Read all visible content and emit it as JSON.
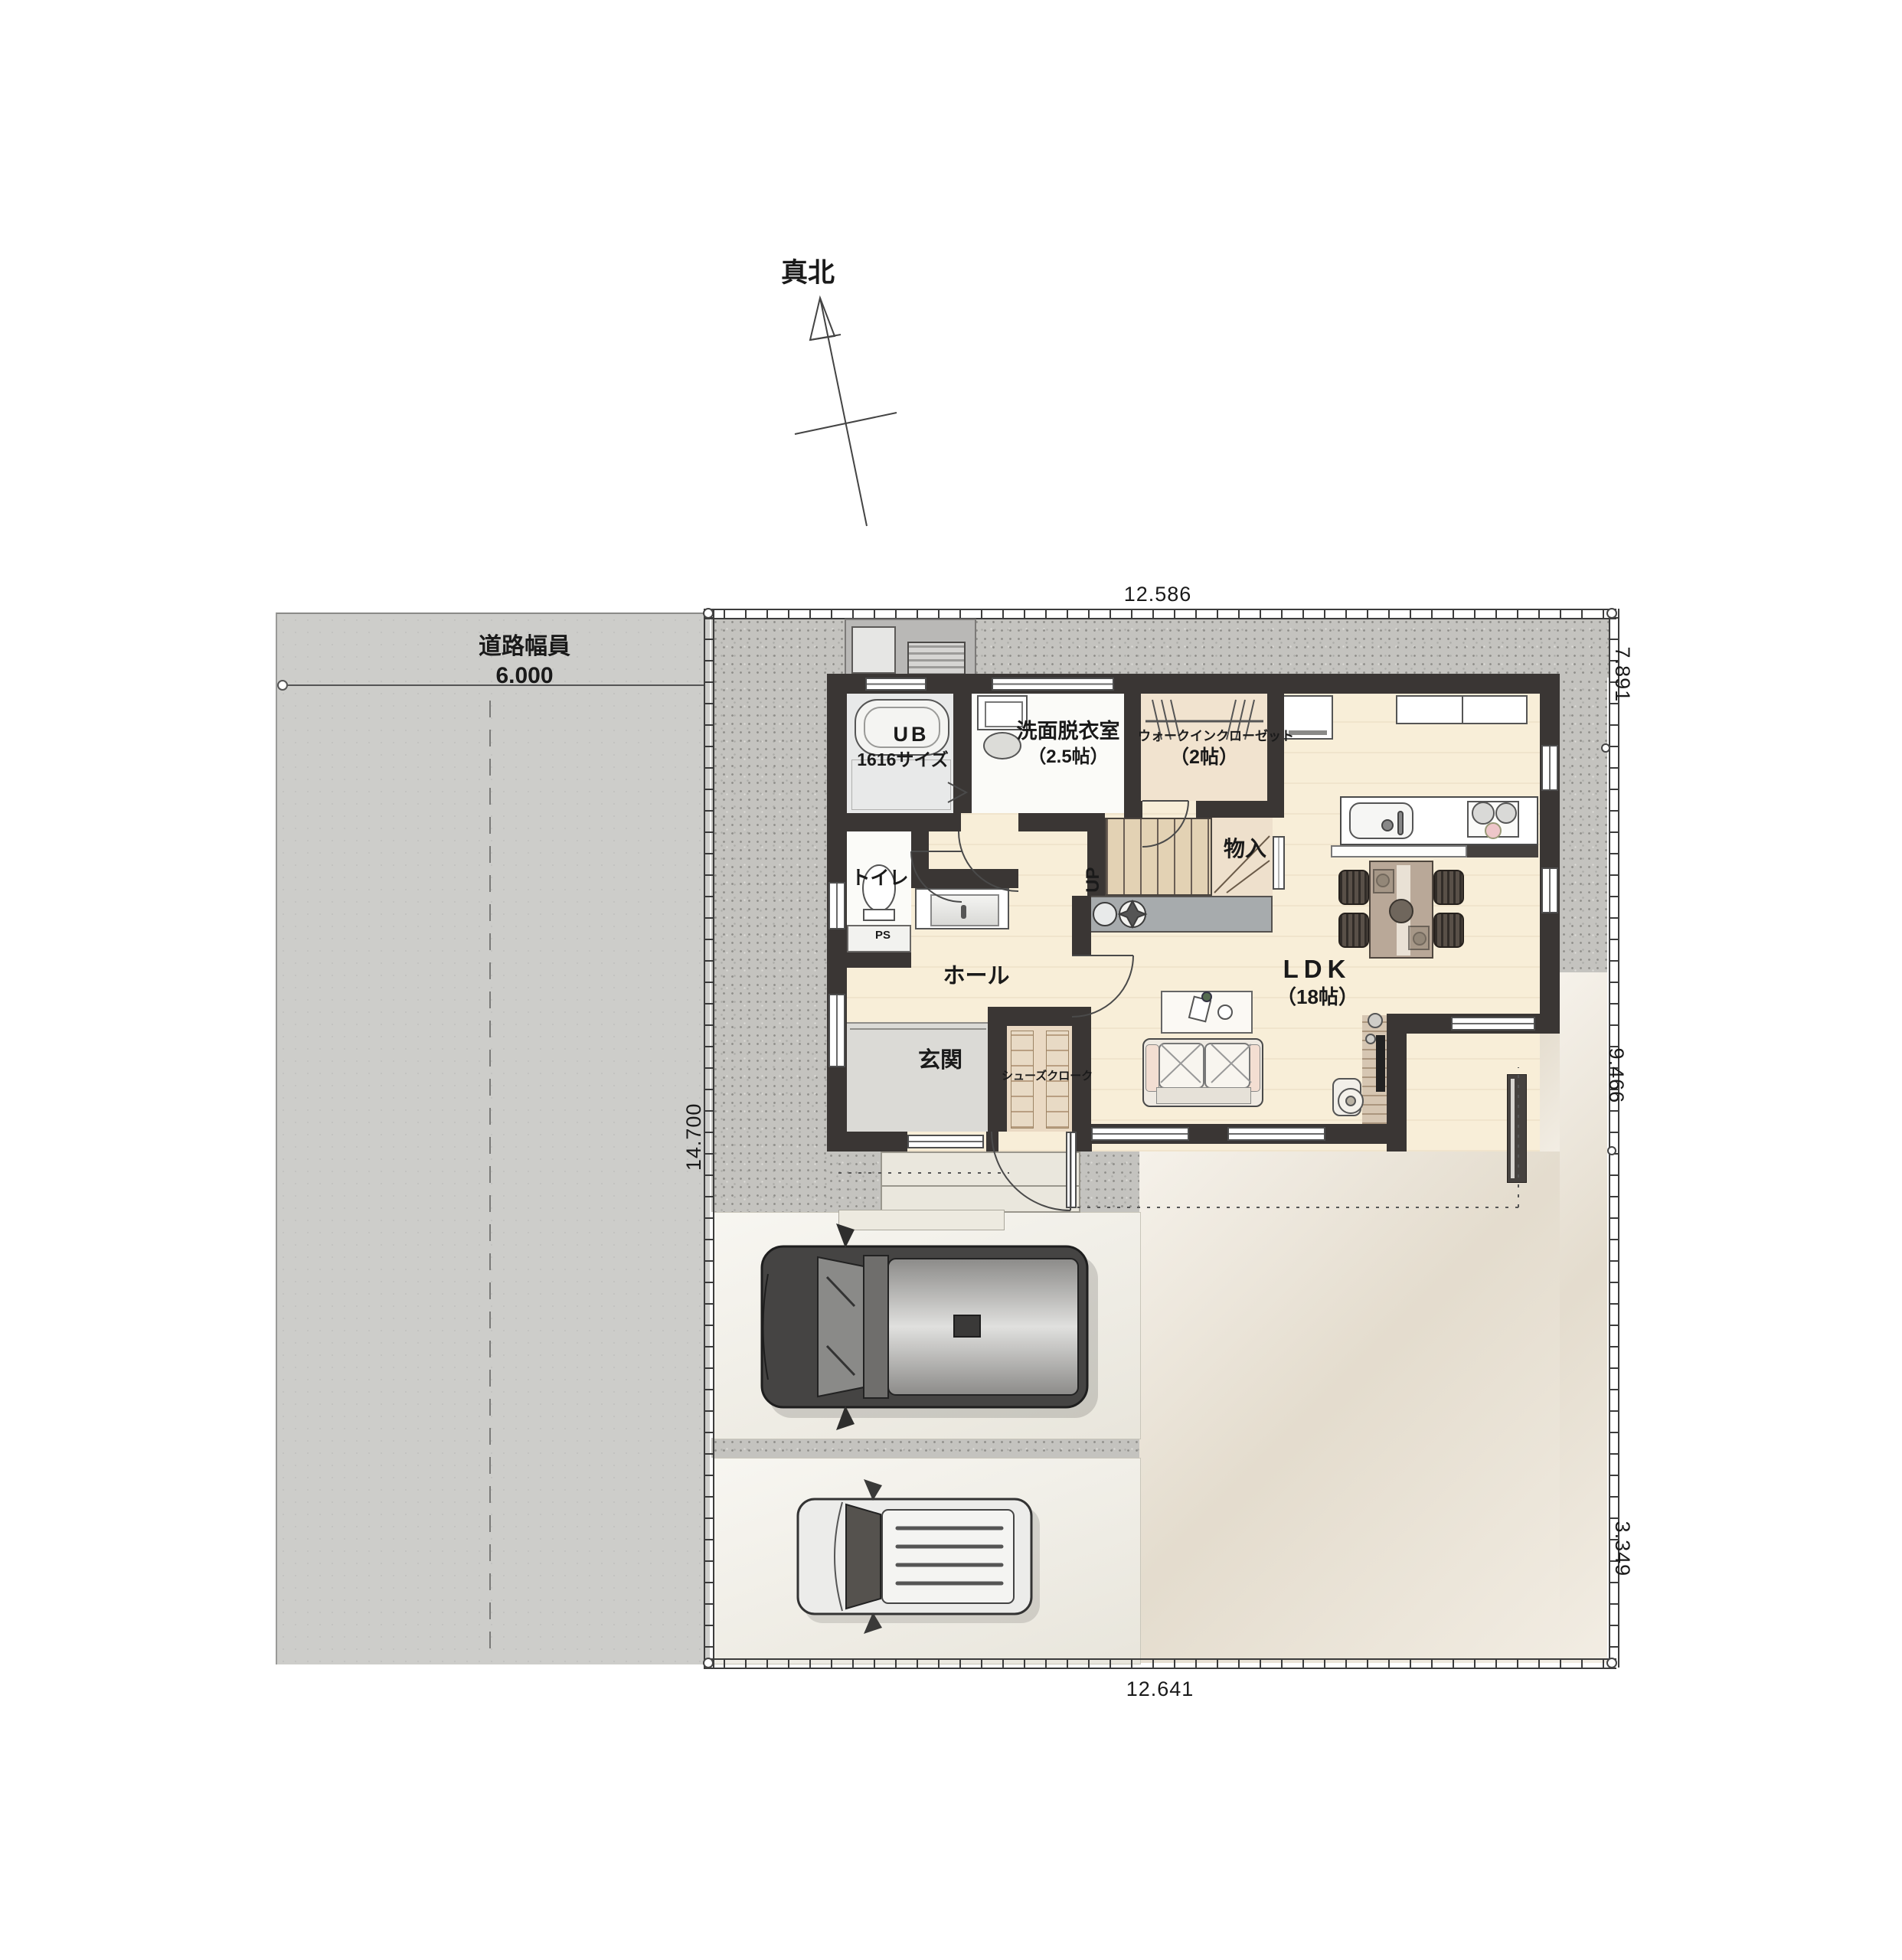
{
  "compass": {
    "label": "真北"
  },
  "road": {
    "name": "道路幅員",
    "width": "6.000"
  },
  "dimensions": {
    "top": "12.586",
    "bottom": "12.641",
    "left": "14.700",
    "right_top": "7.891",
    "right_middle": "9.466",
    "right_bottom": "3.349"
  },
  "rooms": {
    "ub": {
      "name": "UB",
      "size": "1616サイズ"
    },
    "senmen": {
      "name": "洗面脱衣室",
      "size": "（2.5帖）"
    },
    "wic": {
      "name": "ウォークインクローゼット",
      "size": "（2帖）"
    },
    "toilet": {
      "name": "トイレ"
    },
    "ps": {
      "name": "PS"
    },
    "hall": {
      "name": "ホール"
    },
    "genkan": {
      "name": "玄関"
    },
    "shoecloak": {
      "name": "シューズクローク"
    },
    "monoire": {
      "name": "物入"
    },
    "stairs": {
      "name": "UP"
    },
    "ldk": {
      "name": "LDK",
      "size": "（18帖）"
    }
  },
  "colors": {
    "wall": "#3a3634",
    "wood_floor": "#f8eed8",
    "gravel": "#c4c3bf",
    "road": "#cdcdca",
    "terrace": "#ece4d5",
    "parking": "#f0ede3",
    "entrance_tile": "#dbdad6",
    "counter_gray": "#a7abad",
    "stove_accent": "#eec6c9"
  }
}
